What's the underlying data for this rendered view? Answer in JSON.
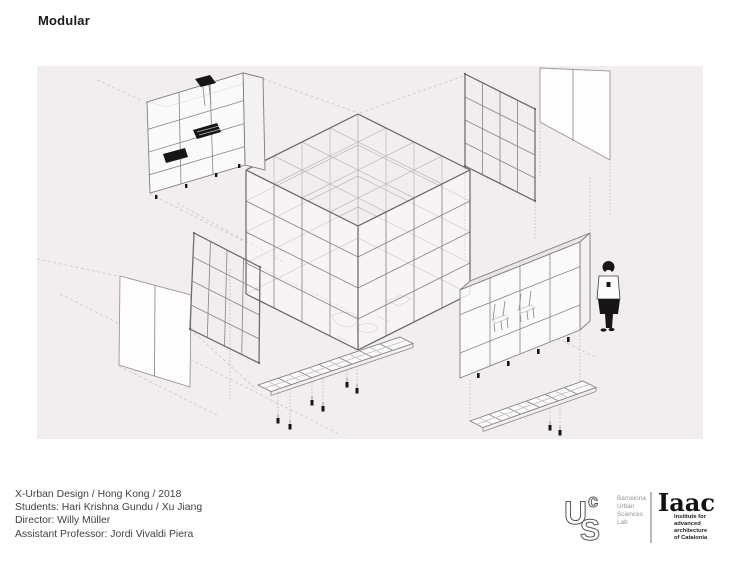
{
  "header": {
    "title": "Modular"
  },
  "credits": {
    "lines": [
      "X-Urban Design / Hong Kong / 2018",
      "Students: Hari Krishna Gundu / Xu Jiang",
      "Director: Willy Müller",
      "Assistant Professor: Jordi Vivaldi Piera"
    ]
  },
  "footer": {
    "bus_logo": {
      "letter_u": "U",
      "letter_c": "c",
      "letter_s": "S",
      "label_lines": [
        "Barcelona",
        "Urban",
        "Sciences",
        "Lab"
      ]
    },
    "iaac_logo": {
      "wordmark": "Iaac",
      "label_lines": [
        "Institute for",
        "advanced",
        "architecture",
        "of Catalonia"
      ]
    }
  },
  "drawing": {
    "background_color": "#f2eeef",
    "line_color": "#8d888b",
    "components": [
      "kitchen-module",
      "central-frame-structure",
      "grid-panel-upper-right",
      "blank-panels-upper-right",
      "grid-panel-left",
      "blank-panel-left",
      "furniture-module-right",
      "human-figure",
      "floor-platform-center",
      "floor-platform-right"
    ]
  }
}
